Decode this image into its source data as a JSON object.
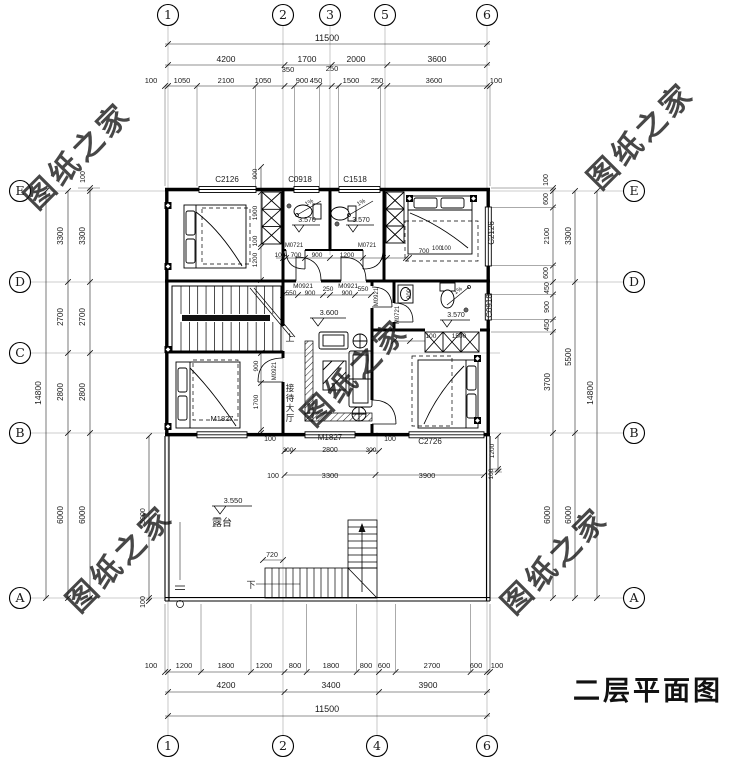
{
  "title": {
    "text": "二层平面图"
  },
  "legend": {
    "rooms": [
      "接待大厅",
      "露台"
    ],
    "level_marks": [
      "3.570",
      "3.600",
      "3.550"
    ],
    "door_codes": [
      "M0921",
      "M0721",
      "M1827"
    ],
    "window_codes": [
      "C2126",
      "C0918",
      "C1518",
      "C2726"
    ],
    "stair_up": "上",
    "stair_down": "下",
    "overall_width": "11500",
    "overall_depth": "14800"
  },
  "watermark": {
    "text": "图纸之家",
    "color": "#c23b2e",
    "positions": [
      [
        85,
        163
      ],
      [
        648,
        143
      ],
      [
        362,
        380
      ],
      [
        127,
        566
      ],
      [
        562,
        568
      ]
    ]
  },
  "axis_bubbles": {
    "top": [
      [
        "1",
        168
      ],
      [
        "2",
        283
      ],
      [
        "3",
        330
      ],
      [
        "5",
        385
      ],
      [
        "6",
        487
      ]
    ],
    "bottom": [
      [
        "1",
        168
      ],
      [
        "2",
        283
      ],
      [
        "4",
        377
      ],
      [
        "6",
        487
      ]
    ],
    "left": [
      [
        "E",
        191
      ],
      [
        "D",
        282
      ],
      [
        "C",
        353
      ],
      [
        "B",
        433
      ],
      [
        "A",
        598
      ]
    ],
    "right": [
      [
        "E",
        191
      ],
      [
        "D",
        282
      ],
      [
        "B",
        433
      ],
      [
        "A",
        598
      ]
    ]
  },
  "annotations": [
    [
      "11500",
      327,
      41,
      9
    ],
    [
      "4200",
      226,
      62,
      8.5
    ],
    [
      "1700",
      307,
      62,
      8.5
    ],
    [
      "2000",
      356,
      62,
      8.5
    ],
    [
      "3600",
      437,
      62,
      8.5
    ],
    [
      "100",
      151,
      83,
      7.5
    ],
    [
      "1050",
      182,
      83,
      7.5
    ],
    [
      "2100",
      226,
      83,
      7.5
    ],
    [
      "1050",
      263,
      83,
      7.5
    ],
    [
      "350",
      288,
      72,
      7.5
    ],
    [
      "900",
      302,
      83,
      7.5
    ],
    [
      "450",
      316,
      83,
      7.5
    ],
    [
      "250",
      332,
      71,
      7.5
    ],
    [
      "1500",
      351,
      83,
      7.5
    ],
    [
      "250",
      377,
      83,
      7.5
    ],
    [
      "3600",
      434,
      83,
      7.5
    ],
    [
      "100",
      496,
      83,
      7.5
    ],
    [
      "100",
      151,
      668,
      7.5
    ],
    [
      "1200",
      184,
      668,
      7.5
    ],
    [
      "1800",
      226,
      668,
      7.5
    ],
    [
      "1200",
      264,
      668,
      7.5
    ],
    [
      "800",
      295,
      668,
      7.5
    ],
    [
      "1800",
      331,
      668,
      7.5
    ],
    [
      "800",
      366,
      668,
      7.5
    ],
    [
      "600",
      384,
      668,
      7.5
    ],
    [
      "2700",
      432,
      668,
      7.5
    ],
    [
      "600",
      476,
      668,
      7.5
    ],
    [
      "100",
      497,
      668,
      7.5
    ],
    [
      "4200",
      226,
      688,
      8.5
    ],
    [
      "3400",
      331,
      688,
      8.5
    ],
    [
      "3900",
      428,
      688,
      8.5
    ],
    [
      "11500",
      327,
      712,
      9
    ],
    [
      "14800",
      41,
      393,
      8.5,
      -90
    ],
    [
      "3300",
      63,
      236,
      8,
      -90
    ],
    [
      "2700",
      63,
      317,
      8,
      -90
    ],
    [
      "2800",
      63,
      392,
      8,
      -90
    ],
    [
      "6000",
      63,
      515,
      8,
      -90
    ],
    [
      "3300",
      85,
      236,
      8,
      -90
    ],
    [
      "2700",
      85,
      317,
      8,
      -90
    ],
    [
      "2800",
      85,
      392,
      8,
      -90
    ],
    [
      "6000",
      85,
      515,
      8,
      -90
    ],
    [
      "100",
      85,
      177,
      7,
      -90
    ],
    [
      "5900",
      145,
      516,
      7,
      -90
    ],
    [
      "100",
      145,
      602,
      7,
      -90
    ],
    [
      "100",
      548,
      180,
      7,
      -90
    ],
    [
      "600",
      548,
      199,
      7,
      -90
    ],
    [
      "2100",
      549,
      236,
      7.5,
      -90
    ],
    [
      "600",
      548,
      273,
      7,
      -90
    ],
    [
      "450",
      549,
      288,
      7,
      -90
    ],
    [
      "900",
      549,
      307,
      7,
      -90
    ],
    [
      "450",
      549,
      325,
      7,
      -90
    ],
    [
      "3700",
      550,
      382,
      8,
      -90
    ],
    [
      "6000",
      550,
      515,
      8,
      -90
    ],
    [
      "3300",
      571,
      236,
      8,
      -90
    ],
    [
      "5500",
      571,
      357,
      8,
      -90
    ],
    [
      "6000",
      571,
      515,
      8,
      -90
    ],
    [
      "14800",
      593,
      393,
      8.5,
      -90
    ],
    [
      "1200",
      494,
      451,
      6.5,
      -90
    ],
    [
      "100",
      493,
      474,
      6.5,
      -90
    ],
    [
      "C2126",
      227,
      182,
      8
    ],
    [
      "C0918",
      300,
      182,
      8
    ],
    [
      "C1518",
      355,
      182,
      8
    ],
    [
      "C2126",
      494,
      233,
      8,
      -90
    ],
    [
      "C0918",
      492,
      306,
      8,
      -90
    ],
    [
      "C2726",
      430,
      444,
      8
    ],
    [
      "M1827",
      330,
      440,
      8
    ],
    [
      "M1827",
      222,
      421,
      7.5
    ],
    [
      "M0721",
      294,
      247,
      6
    ],
    [
      "M0721",
      367,
      247,
      6
    ],
    [
      "M0921",
      303,
      288,
      6.5
    ],
    [
      "M0921",
      348,
      288,
      6.5
    ],
    [
      "M0921",
      378,
      297,
      6,
      -90
    ],
    [
      "M0721",
      399,
      315,
      6,
      -90
    ],
    [
      "M0921",
      276,
      371,
      6,
      -90
    ],
    [
      "900",
      257,
      174,
      6.5,
      -90
    ],
    [
      "1900",
      257,
      213,
      6.5,
      -90
    ],
    [
      "100",
      257,
      241,
      6.5,
      -90
    ],
    [
      "1200",
      257,
      260,
      6.5,
      -90
    ],
    [
      "100",
      280,
      257,
      6.5
    ],
    [
      "700",
      296,
      257,
      6.5
    ],
    [
      "900",
      317,
      257,
      6.5
    ],
    [
      "1200",
      347,
      257,
      6.5
    ],
    [
      "700",
      424,
      253,
      6.5
    ],
    [
      "100",
      437,
      250,
      6
    ],
    [
      "100",
      446,
      250,
      6
    ],
    [
      "550",
      291,
      295,
      6.5
    ],
    [
      "900",
      310,
      295,
      6.5
    ],
    [
      "250",
      328,
      291,
      6.5
    ],
    [
      "900",
      347,
      295,
      6.5
    ],
    [
      "550",
      363,
      291,
      6.5
    ],
    [
      "900",
      411,
      294,
      6,
      -90
    ],
    [
      "1500",
      459,
      338,
      6.5
    ],
    [
      "100",
      431,
      338,
      6.5
    ],
    [
      "900",
      258,
      366,
      6.5,
      -90
    ],
    [
      "1700",
      258,
      402,
      6.5,
      -90
    ],
    [
      "100",
      270,
      441,
      7
    ],
    [
      "100",
      390,
      441,
      7
    ],
    [
      "300",
      288,
      452,
      6.5
    ],
    [
      "2800",
      330,
      452,
      7
    ],
    [
      "300",
      371,
      452,
      6.5
    ],
    [
      "100",
      273,
      478,
      7
    ],
    [
      "3300",
      330,
      478,
      7.5
    ],
    [
      "3900",
      427,
      478,
      7.5
    ],
    [
      "720",
      272,
      557,
      7
    ],
    [
      "下",
      251,
      588,
      9
    ],
    [
      "上",
      290,
      341,
      9
    ],
    [
      "3.570",
      307,
      222,
      7
    ],
    [
      "3.570",
      361,
      222,
      7
    ],
    [
      "3.570",
      456,
      317,
      7
    ],
    [
      "3.600",
      329,
      315,
      7.5
    ],
    [
      "3.550",
      233,
      503,
      7.5
    ],
    [
      "1%",
      310,
      204,
      6,
      -30
    ],
    [
      "1%",
      362,
      204,
      6,
      -30
    ],
    [
      "1%",
      459,
      292,
      6,
      -35
    ],
    [
      "露台",
      222,
      526,
      10
    ],
    [
      "接待大厅",
      290,
      391,
      8.5,
      0,
      1
    ]
  ]
}
